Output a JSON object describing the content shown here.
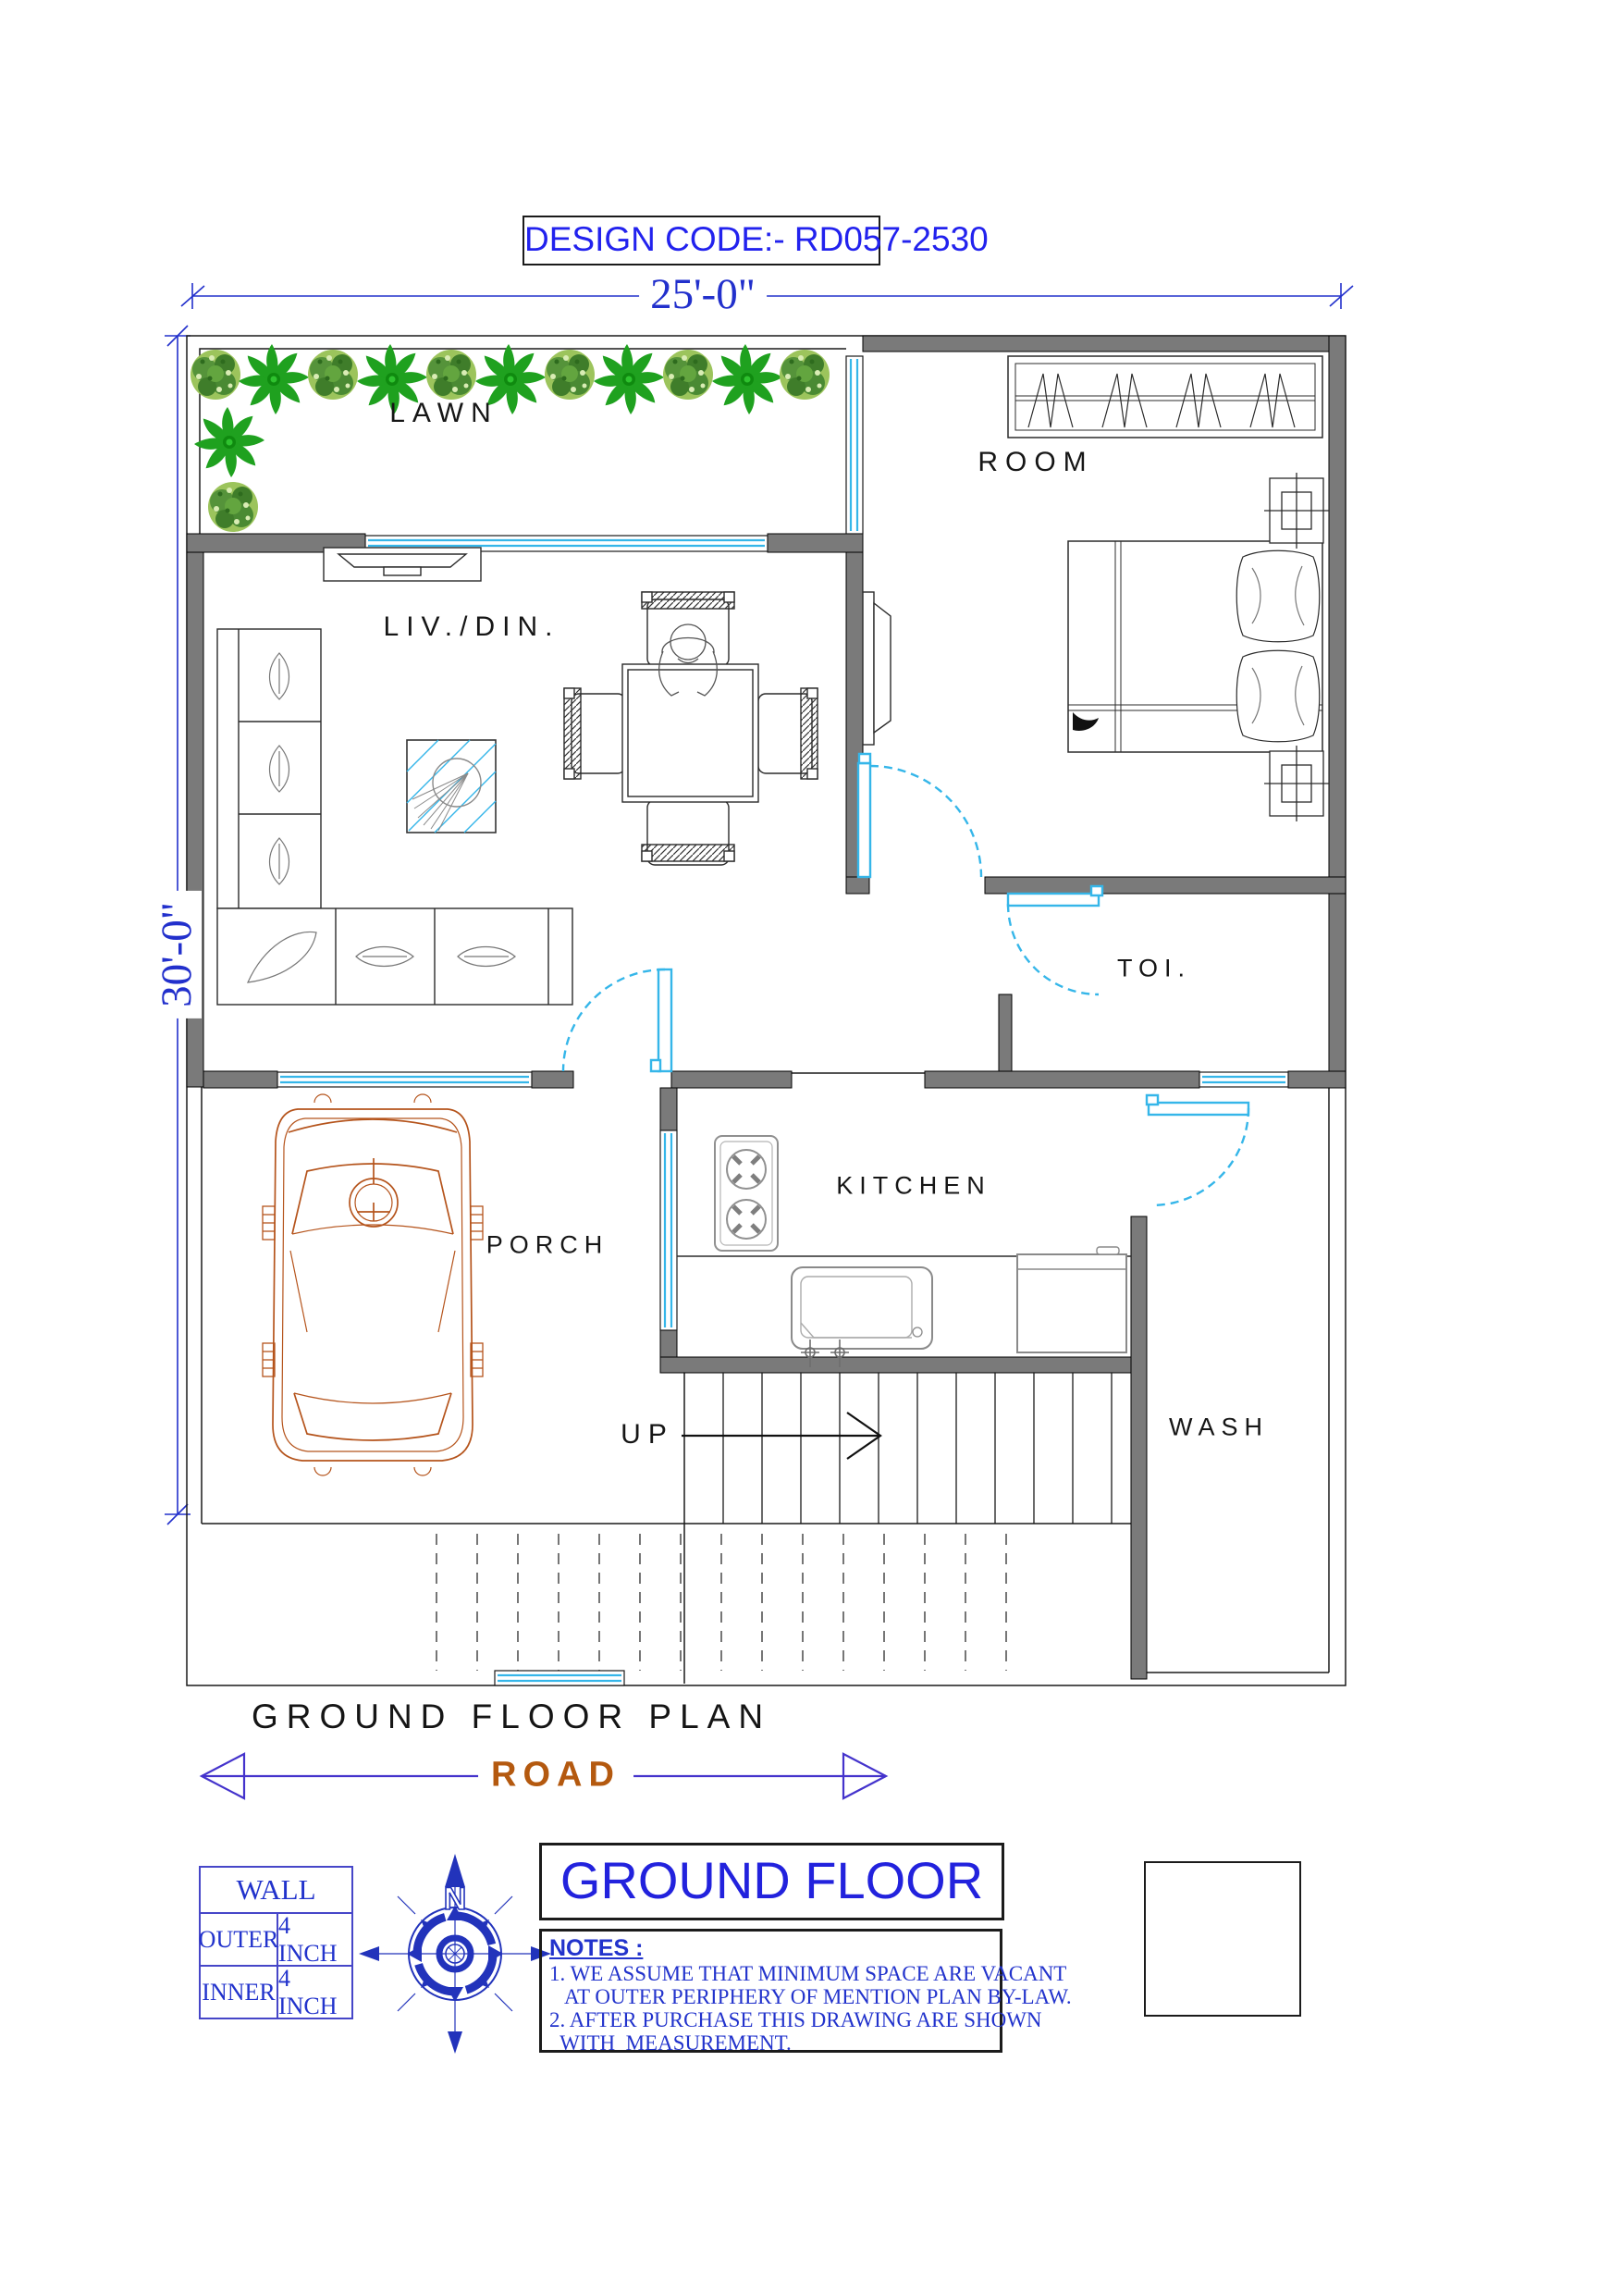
{
  "design_code": "DESIGN CODE:- RD057-2530",
  "dimensions": {
    "width": "25'-0\"",
    "height": "30'-0\""
  },
  "rooms": {
    "lawn": "LAWN",
    "room": "ROOM",
    "living": "LIV./DIN.",
    "toilet": "TOI.",
    "kitchen": "KITCHEN",
    "porch": "PORCH",
    "wash": "WASH",
    "stairs_up": "UP"
  },
  "plan_title": "GROUND FLOOR PLAN",
  "road": "ROAD",
  "floor_title": "GROUND FLOOR",
  "wall_table": {
    "header": "WALL",
    "rows": [
      {
        "label": "OUTER",
        "value": "4 INCH"
      },
      {
        "label": "INNER",
        "value": "4 INCH"
      }
    ]
  },
  "notes": {
    "heading": "NOTES :",
    "lines": [
      "1. WE ASSUME THAT MINIMUM SPACE ARE VACANT",
      "   AT OUTER PERIPHERY OF MENTION PLAN BY-LAW.",
      "2. AFTER PURCHASE THIS DRAWING ARE SHOWN",
      "  WITH  MEASUREMENT."
    ]
  },
  "compass": {
    "north": "N"
  },
  "logo": {
    "line1": "Makan Ki",
    "line2": "Dukan"
  },
  "colors": {
    "dimension_blue": "#2230cc",
    "wall_gray": "#7a7a7a",
    "glazing_cyan": "#35b6e9",
    "plant_green": "#22a322",
    "car_orange": "#b5541c",
    "road_orange": "#b4590f",
    "logo_blue": "#2b4a8b",
    "logo_orange": "#ef8220"
  }
}
